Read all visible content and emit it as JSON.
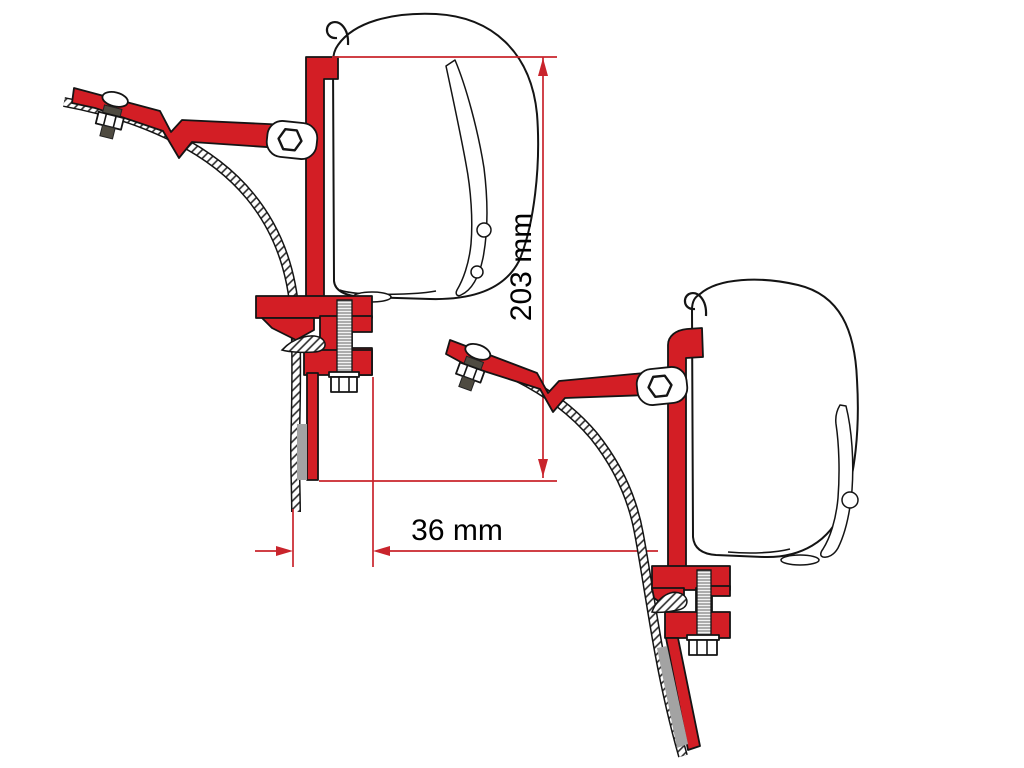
{
  "diagram": {
    "dimensions": {
      "height_label": "203 mm",
      "width_label": "36 mm"
    },
    "colors": {
      "bracket_red": "#d31e25",
      "dimension_red": "#c9242c",
      "outline": "#141414",
      "metal_gray": "#a3a3a3",
      "hardware_dark": "#4f4b41",
      "background": "#ffffff"
    }
  }
}
